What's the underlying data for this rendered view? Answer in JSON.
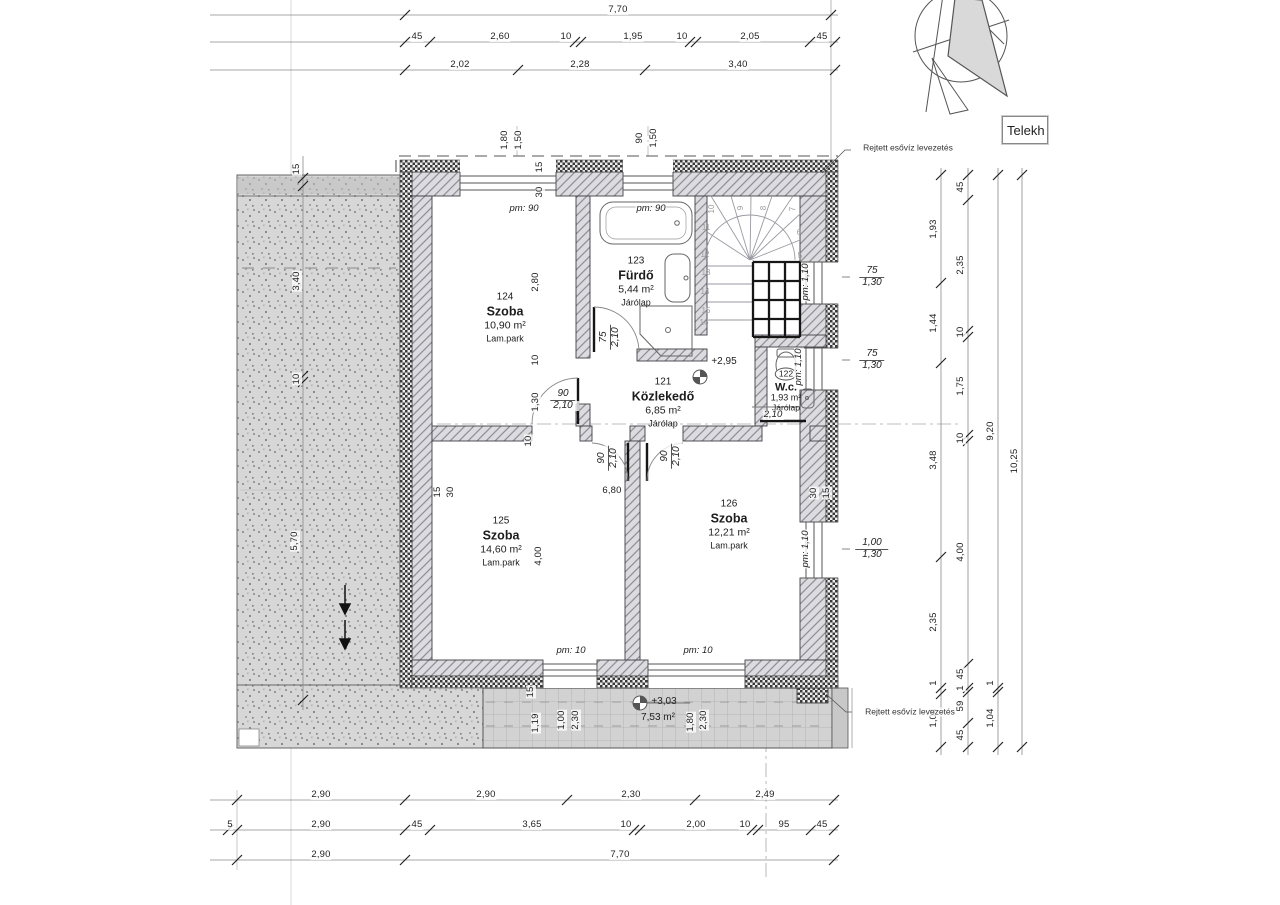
{
  "telek_box": {
    "label": "Telekh"
  },
  "rooms": [
    {
      "no": "124",
      "name": "Szoba",
      "area": "10,90 m²",
      "floor": "Lam.park",
      "x": 505,
      "y": 318
    },
    {
      "no": "123",
      "name": "Fürdő",
      "area": "5,44 m²",
      "floor": "Járólap",
      "x": 636,
      "y": 282
    },
    {
      "no": "121",
      "name": "Közlekedő",
      "area": "6,85 m²",
      "floor": "Járólap",
      "x": 663,
      "y": 403
    },
    {
      "no": "122",
      "name": "W.c.",
      "area": "1,93 m²",
      "floor": "Járólap",
      "x": 786,
      "y": 388,
      "small": true
    },
    {
      "no": "125",
      "name": "Szoba",
      "area": "14,60 m²",
      "floor": "Lam.park",
      "x": 501,
      "y": 542
    },
    {
      "no": "126",
      "name": "Szoba",
      "area": "12,21 m²",
      "floor": "Lam.park",
      "x": 729,
      "y": 525
    }
  ],
  "labels": [
    {
      "t": "7,70",
      "x": 618,
      "y": 10
    },
    {
      "t": "45",
      "x": 417,
      "y": 37
    },
    {
      "t": "2,60",
      "x": 500,
      "y": 37
    },
    {
      "t": "10",
      "x": 566,
      "y": 37
    },
    {
      "t": "1,95",
      "x": 633,
      "y": 37
    },
    {
      "t": "10",
      "x": 682,
      "y": 37
    },
    {
      "t": "2,05",
      "x": 750,
      "y": 37
    },
    {
      "t": "45",
      "x": 822,
      "y": 37
    },
    {
      "t": "2,02",
      "x": 460,
      "y": 65
    },
    {
      "t": "2,28",
      "x": 580,
      "y": 65
    },
    {
      "t": "3,40",
      "x": 738,
      "y": 65
    },
    {
      "t": "2,90",
      "x": 321,
      "y": 795
    },
    {
      "t": "2,90",
      "x": 486,
      "y": 795
    },
    {
      "t": "2,30",
      "x": 631,
      "y": 795
    },
    {
      "t": "2,49",
      "x": 765,
      "y": 795
    },
    {
      "t": "5",
      "x": 230,
      "y": 825
    },
    {
      "t": "2,90",
      "x": 321,
      "y": 825
    },
    {
      "t": "45",
      "x": 417,
      "y": 825
    },
    {
      "t": "3,65",
      "x": 532,
      "y": 825
    },
    {
      "t": "10",
      "x": 626,
      "y": 825
    },
    {
      "t": "2,00",
      "x": 696,
      "y": 825
    },
    {
      "t": "10",
      "x": 745,
      "y": 825
    },
    {
      "t": "95",
      "x": 784,
      "y": 825
    },
    {
      "t": "45",
      "x": 822,
      "y": 825
    },
    {
      "t": "2,90",
      "x": 321,
      "y": 855
    },
    {
      "t": "7,70",
      "x": 620,
      "y": 855
    },
    {
      "t": "1,93",
      "x": 934,
      "y": 229,
      "r": -90
    },
    {
      "t": "1,44",
      "x": 934,
      "y": 323,
      "r": -90
    },
    {
      "t": "3,48",
      "x": 934,
      "y": 460,
      "r": -90
    },
    {
      "t": "2,35",
      "x": 934,
      "y": 622,
      "r": -90
    },
    {
      "t": "1",
      "x": 934,
      "y": 683,
      "r": -90
    },
    {
      "t": "1,04",
      "x": 934,
      "y": 718,
      "r": -90
    },
    {
      "t": "45",
      "x": 961,
      "y": 187,
      "r": -90
    },
    {
      "t": "2,35",
      "x": 961,
      "y": 265,
      "r": -90
    },
    {
      "t": "10",
      "x": 961,
      "y": 332,
      "r": -90
    },
    {
      "t": "1,75",
      "x": 961,
      "y": 386,
      "r": -90
    },
    {
      "t": "10",
      "x": 961,
      "y": 438,
      "r": -90
    },
    {
      "t": "4,00",
      "x": 961,
      "y": 552,
      "r": -90
    },
    {
      "t": "45",
      "x": 961,
      "y": 674,
      "r": -90
    },
    {
      "t": "1",
      "x": 961,
      "y": 688,
      "r": -90
    },
    {
      "t": "59",
      "x": 961,
      "y": 706,
      "r": -90
    },
    {
      "t": "45",
      "x": 961,
      "y": 735,
      "r": -90
    },
    {
      "t": "9,20",
      "x": 991,
      "y": 431,
      "r": -90
    },
    {
      "t": "1",
      "x": 991,
      "y": 683,
      "r": -90
    },
    {
      "t": "1,04",
      "x": 991,
      "y": 718,
      "r": -90
    },
    {
      "t": "10,25",
      "x": 1015,
      "y": 461,
      "r": -90
    },
    {
      "t": "15",
      "x": 297,
      "y": 169,
      "r": -90
    },
    {
      "t": "3,40",
      "x": 297,
      "y": 281,
      "r": -90
    },
    {
      "t": "10",
      "x": 297,
      "y": 379,
      "r": -90
    },
    {
      "t": "5,70",
      "x": 295,
      "y": 541,
      "r": -90
    },
    {
      "t": "1,80",
      "x": 505,
      "y": 140,
      "r": -90
    },
    {
      "t": "1,50",
      "x": 519,
      "y": 140,
      "r": -90
    },
    {
      "t": "90",
      "x": 640,
      "y": 138,
      "r": -90
    },
    {
      "t": "1,50",
      "x": 654,
      "y": 138,
      "r": -90
    },
    {
      "t": "15",
      "x": 540,
      "y": 167,
      "r": -90
    },
    {
      "t": "30",
      "x": 540,
      "y": 192,
      "r": -90
    },
    {
      "t": "2,80",
      "x": 536,
      "y": 282,
      "r": -90
    },
    {
      "t": "10",
      "x": 536,
      "y": 360,
      "r": -90
    },
    {
      "t": "1,30",
      "x": 536,
      "y": 402,
      "r": -90
    },
    {
      "t": "10",
      "x": 529,
      "y": 441,
      "r": -90
    },
    {
      "t": "4,00",
      "x": 539,
      "y": 556,
      "r": -90
    },
    {
      "t": "15",
      "x": 438,
      "y": 492,
      "r": -90
    },
    {
      "t": "30",
      "x": 451,
      "y": 492,
      "r": -90
    },
    {
      "t": "30",
      "x": 814,
      "y": 493,
      "r": -90
    },
    {
      "t": "15",
      "x": 827,
      "y": 493,
      "r": -90
    },
    {
      "t": "15",
      "x": 531,
      "y": 692,
      "r": -90
    },
    {
      "t": "1,19",
      "x": 536,
      "y": 723,
      "r": -90
    },
    {
      "t": "1,00",
      "x": 562,
      "y": 720,
      "r": -90
    },
    {
      "t": "2,30",
      "x": 576,
      "y": 720,
      "r": -90
    },
    {
      "t": "1,80",
      "x": 691,
      "y": 722,
      "r": -90
    },
    {
      "t": "2,30",
      "x": 704,
      "y": 720,
      "r": -90
    },
    {
      "t": "6,80",
      "x": 612,
      "y": 491
    },
    {
      "t": "10",
      "x": 712,
      "y": 209,
      "r": -90,
      "k": "snum"
    },
    {
      "t": "9",
      "x": 741,
      "y": 208,
      "r": -90,
      "k": "snum"
    },
    {
      "t": "8",
      "x": 764,
      "y": 208,
      "r": -90,
      "k": "snum"
    },
    {
      "t": "7",
      "x": 793,
      "y": 209,
      "r": -90,
      "k": "snum"
    },
    {
      "t": "11",
      "x": 706,
      "y": 228,
      "k": "snum"
    },
    {
      "t": "12",
      "x": 705,
      "y": 255,
      "k": "snum"
    },
    {
      "t": "13",
      "x": 706,
      "y": 273,
      "k": "snum"
    },
    {
      "t": "14",
      "x": 705,
      "y": 292,
      "k": "snum"
    },
    {
      "t": "15",
      "x": 706,
      "y": 311,
      "k": "snum"
    },
    {
      "t": "16",
      "x": 704,
      "y": 323,
      "k": "snum"
    },
    {
      "t": "6",
      "x": 799,
      "y": 233,
      "k": "snum"
    },
    {
      "t": "5",
      "x": 800,
      "y": 256,
      "k": "snum"
    },
    {
      "t": "pm: 90",
      "x": 524,
      "y": 209,
      "k": "pm"
    },
    {
      "t": "pm: 90",
      "x": 651,
      "y": 209,
      "k": "pm"
    },
    {
      "t": "pm: 1,10",
      "x": 806,
      "y": 282,
      "r": -90,
      "k": "pm"
    },
    {
      "t": "pm: 1,10",
      "x": 799,
      "y": 367,
      "r": -90,
      "k": "pm"
    },
    {
      "t": "pm: 1,10",
      "x": 806,
      "y": 549,
      "r": -90,
      "k": "pm"
    },
    {
      "t": "pm: 10",
      "x": 571,
      "y": 651,
      "k": "pm"
    },
    {
      "t": "pm: 10",
      "x": 698,
      "y": 651,
      "k": "pm"
    },
    {
      "t": "2,10",
      "x": 773,
      "y": 415,
      "k": "pm"
    },
    {
      "t": "75",
      "b": "1,30",
      "x": 872,
      "y": 277,
      "k": "frac"
    },
    {
      "t": "75",
      "b": "1,30",
      "x": 872,
      "y": 360,
      "k": "frac"
    },
    {
      "t": "1,00",
      "b": "1,30",
      "x": 872,
      "y": 549,
      "k": "frac"
    },
    {
      "t": "90",
      "b": "2,10",
      "x": 563,
      "y": 400,
      "k": "frac"
    },
    {
      "t": "90",
      "b": "2,10",
      "x": 608,
      "y": 458,
      "r": -90,
      "k": "frac"
    },
    {
      "t": "90",
      "b": "2,10",
      "x": 671,
      "y": 456,
      "r": -90,
      "k": "frac"
    },
    {
      "t": "75",
      "b": "2,10",
      "x": 610,
      "y": 337,
      "r": -90,
      "k": "frac"
    },
    {
      "t": "+2,95",
      "x": 724,
      "y": 362,
      "k": "level"
    },
    {
      "t": "+3,03",
      "x": 664,
      "y": 702,
      "k": "level"
    },
    {
      "t": "7,53 m²",
      "x": 658,
      "y": 718,
      "k": "level"
    },
    {
      "t": "Rejtett esővíz levezetés",
      "x": 908,
      "y": 148,
      "k": "note"
    },
    {
      "t": "Rejtett esővíz levezetés",
      "x": 910,
      "y": 712,
      "k": "note"
    }
  ]
}
